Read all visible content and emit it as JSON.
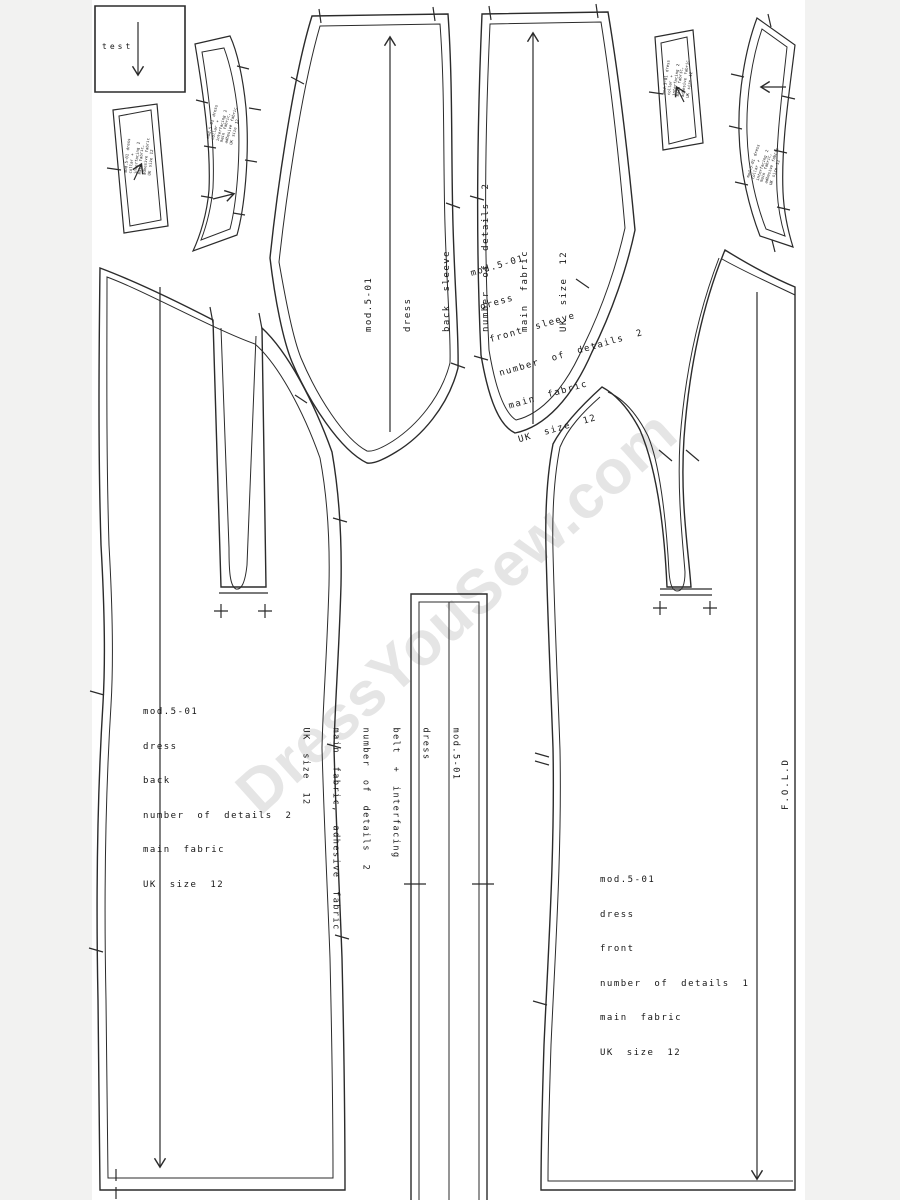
{
  "watermark": {
    "text": "DressYouSew.com",
    "color": "#e5e5e5"
  },
  "test_square": {
    "label": "test"
  },
  "fold": {
    "label": "F.O.L.D"
  },
  "piece_labels": {
    "back_sleeve": [
      "mod.5-01",
      "dress",
      "back sleeve",
      "number of details 2",
      "main fabric",
      "UK size 12"
    ],
    "front_sleeve": [
      "mod.5-01",
      "dress",
      "front sleeve",
      "number of details 2",
      "main fabric",
      "UK size 12"
    ],
    "back": [
      "mod.5-01",
      "dress",
      "back",
      "number of details 2",
      "main fabric",
      "UK size 12"
    ],
    "front": [
      "mod.5-01",
      "dress",
      "front",
      "number of details 1",
      "main fabric",
      "UK size 12"
    ],
    "belt": [
      "mod.5-01",
      "dress",
      "belt + interfacing",
      "number of details 2",
      "main fabric, adhesive fabric",
      "UK size 12"
    ]
  },
  "small_piece_labels": {
    "collar_band_left": "mod.5-01 dress collar + interfacing 2 main fabric, adhesive fabric UK size 12",
    "collar_strip_left": "mod.5-01 dress collar + interfacing 2 main fabric, adhesive fabric UK size 12",
    "collar_strip_right": "mod.5-01 dress collar + interfacing 2 main fabric, adhesive fabric UK size 12",
    "collar_band_right": "mod.5-01 dress collar + interfacing 2 main fabric, adhesive fabric UK size 12"
  },
  "colors": {
    "line": "#2b2b2b",
    "margin": "#f2f2f1",
    "page": "#ffffff",
    "watermark": "#e5e5e5"
  }
}
